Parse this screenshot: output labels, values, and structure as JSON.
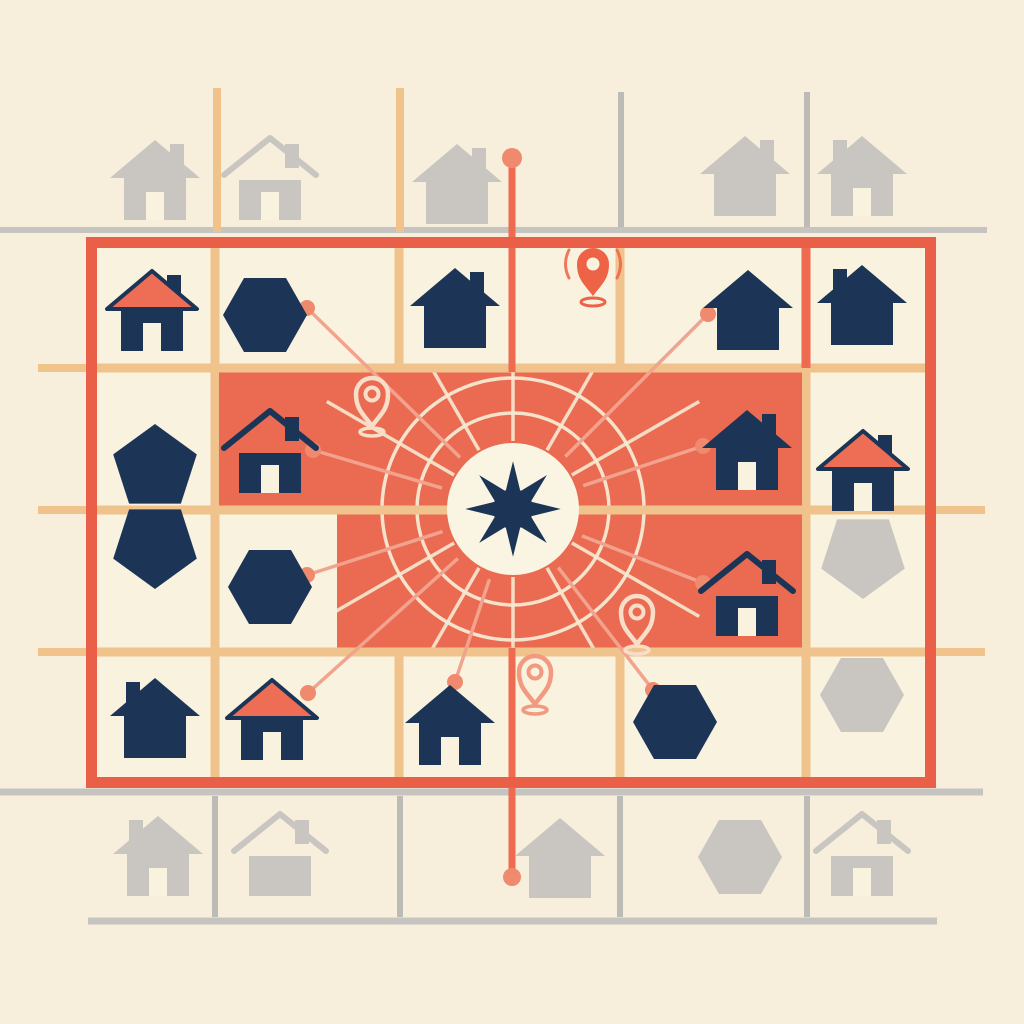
{
  "canvas": {
    "w": 1024,
    "h": 1024
  },
  "palette": {
    "bg": "#F7EFDB",
    "cream": "#F9F2DF",
    "coral_zone": "#EB6A52",
    "coral_border": "#E95F47",
    "coral_roof": "#ED6E55",
    "tan": "#F1C38C",
    "navy": "#1C3557",
    "gray_icon": "#C9C6C1",
    "gray_line": "#BDBBB6",
    "gray_line_light": "#C6C4C0",
    "connector": "#F2A38E",
    "connector_dot": "#EF8A6F",
    "ring": "#F7EAD2",
    "hub_circle": "#FAF4E2",
    "axis": "#EE6A50",
    "pin_filled": "#EE6245",
    "pin_outline_on_coral": "#F8DEC8",
    "pin_outline_on_cream": "#F2997F"
  },
  "outer_lines": {
    "gray_h": [
      {
        "x1": 0,
        "y": 230,
        "x2": 987,
        "w": 6
      },
      {
        "x1": 0,
        "y": 792,
        "x2": 983,
        "w": 7
      },
      {
        "x1": 88,
        "y": 921,
        "x2": 937,
        "w": 7
      }
    ],
    "gray_v": [
      {
        "x": 621,
        "y1": 92,
        "y2": 227
      },
      {
        "x": 807,
        "y1": 92,
        "y2": 227
      },
      {
        "x": 215,
        "y1": 796,
        "y2": 917
      },
      {
        "x": 400,
        "y1": 796,
        "y2": 917
      },
      {
        "x": 620,
        "y1": 796,
        "y2": 917
      },
      {
        "x": 807,
        "y1": 796,
        "y2": 917
      }
    ],
    "tan_v": [
      {
        "x": 217,
        "y1": 88,
        "y2": 232
      },
      {
        "x": 400,
        "y1": 88,
        "y2": 232
      }
    ],
    "tan_stubs": [
      {
        "x1": 38,
        "y": 368,
        "x2": 88
      },
      {
        "x1": 38,
        "y": 510,
        "x2": 88
      },
      {
        "x1": 38,
        "y": 652,
        "x2": 88
      },
      {
        "x1": 934,
        "y": 510,
        "x2": 985
      },
      {
        "x1": 934,
        "y": 652,
        "x2": 985
      }
    ]
  },
  "map": {
    "x": 86,
    "y": 237,
    "w": 850,
    "h": 551,
    "border_w": 11,
    "inner_v": [
      215,
      399,
      620,
      806
    ],
    "inner_h": [
      368,
      510,
      652
    ],
    "coral_v_segment": {
      "x": 806,
      "y1": 246,
      "y2": 368
    }
  },
  "zones": [
    {
      "x": 219,
      "y": 368,
      "w": 583,
      "h": 142
    },
    {
      "x": 337,
      "y": 510,
      "w": 465,
      "h": 142
    }
  ],
  "hub": {
    "cx": 513,
    "cy": 509,
    "r": 66,
    "star_outer": 52,
    "star_inner": 21,
    "rings": [
      96,
      131
    ],
    "spoke_count": 12,
    "spoke_inner": 68,
    "spoke_outer": 215
  },
  "axis_line": {
    "x": 512,
    "w": 7,
    "segments": [
      {
        "y1": 158,
        "y2": 372
      },
      {
        "y1": 648,
        "y2": 877
      }
    ],
    "dots": [
      {
        "y": 158,
        "r": 10
      },
      {
        "y": 877,
        "r": 9
      }
    ]
  },
  "connectors": [
    {
      "x": 307,
      "y": 308,
      "curve": 1
    },
    {
      "x": 313,
      "y": 450,
      "curve": 0
    },
    {
      "x": 307,
      "y": 575,
      "curve": 0
    },
    {
      "x": 308,
      "y": 693,
      "curve": 0
    },
    {
      "x": 455,
      "y": 682,
      "curve": 0
    },
    {
      "x": 653,
      "y": 690,
      "curve": 0
    },
    {
      "x": 703,
      "y": 583,
      "curve": 0
    },
    {
      "x": 703,
      "y": 446,
      "curve": 0
    },
    {
      "x": 708,
      "y": 314,
      "curve": 1
    }
  ],
  "icons": [
    {
      "t": "house",
      "v": "coral",
      "x": 152,
      "y": 308,
      "c": "navy",
      "ch": "r",
      "door": true
    },
    {
      "t": "house",
      "v": "solid",
      "x": 455,
      "y": 305,
      "c": "navy",
      "ch": "r",
      "door": false
    },
    {
      "t": "house",
      "v": "solid",
      "x": 748,
      "y": 307,
      "c": "navy",
      "ch": "none",
      "door": false
    },
    {
      "t": "house",
      "v": "solid",
      "x": 862,
      "y": 302,
      "c": "navy",
      "ch": "l",
      "door": false
    },
    {
      "t": "house",
      "v": "gap",
      "x": 270,
      "y": 450,
      "c": "navy",
      "ch": "r",
      "door": true
    },
    {
      "t": "house",
      "v": "solid",
      "x": 747,
      "y": 447,
      "c": "navy",
      "ch": "r",
      "door": true
    },
    {
      "t": "house",
      "v": "coral",
      "x": 863,
      "y": 468,
      "c": "navy",
      "ch": "r",
      "door": true
    },
    {
      "t": "house",
      "v": "gap",
      "x": 747,
      "y": 593,
      "c": "navy",
      "ch": "r",
      "door": true
    },
    {
      "t": "house",
      "v": "solid",
      "x": 155,
      "y": 715,
      "c": "navy",
      "ch": "l",
      "door": false
    },
    {
      "t": "house",
      "v": "coral",
      "x": 272,
      "y": 717,
      "c": "navy",
      "ch": "none",
      "door": true
    },
    {
      "t": "house",
      "v": "solid",
      "x": 450,
      "y": 722,
      "c": "navy",
      "ch": "none",
      "door": true
    },
    {
      "t": "house",
      "v": "solid",
      "x": 155,
      "y": 177,
      "c": "gray",
      "ch": "r",
      "door": true
    },
    {
      "t": "house",
      "v": "gap",
      "x": 270,
      "y": 177,
      "c": "gray",
      "ch": "r",
      "door": true
    },
    {
      "t": "house",
      "v": "solid",
      "x": 457,
      "y": 181,
      "c": "gray",
      "ch": "r",
      "door": false
    },
    {
      "t": "house",
      "v": "solid",
      "x": 745,
      "y": 173,
      "c": "gray",
      "ch": "r",
      "door": false
    },
    {
      "t": "house",
      "v": "solid",
      "x": 862,
      "y": 173,
      "c": "gray",
      "ch": "l",
      "door": true
    },
    {
      "t": "house",
      "v": "solid",
      "x": 158,
      "y": 853,
      "c": "gray",
      "ch": "l",
      "door": true
    },
    {
      "t": "house",
      "v": "gap",
      "x": 280,
      "y": 853,
      "c": "gray",
      "ch": "r",
      "door": false
    },
    {
      "t": "house",
      "v": "solid",
      "x": 560,
      "y": 855,
      "c": "gray",
      "ch": "none",
      "door": false
    },
    {
      "t": "house",
      "v": "gap",
      "x": 862,
      "y": 853,
      "c": "gray",
      "ch": "r",
      "door": true
    },
    {
      "t": "hex",
      "x": 265,
      "y": 315,
      "c": "navy"
    },
    {
      "t": "hex",
      "x": 270,
      "y": 587,
      "c": "navy"
    },
    {
      "t": "hex",
      "x": 675,
      "y": 722,
      "c": "navy"
    },
    {
      "t": "hex",
      "x": 862,
      "y": 695,
      "c": "gray"
    },
    {
      "t": "hex",
      "x": 740,
      "y": 857,
      "c": "gray"
    },
    {
      "t": "pent",
      "dir": "up",
      "x": 155,
      "y": 468,
      "c": "navy"
    },
    {
      "t": "pent",
      "dir": "down",
      "x": 155,
      "y": 545,
      "c": "navy"
    },
    {
      "t": "pent",
      "dir": "down",
      "x": 863,
      "y": 555,
      "c": "gray"
    },
    {
      "t": "pin",
      "v": "signal",
      "x": 593,
      "y": 296
    },
    {
      "t": "pin",
      "v": "outline_coral",
      "x": 372,
      "y": 426
    },
    {
      "t": "pin",
      "v": "outline_coral",
      "x": 637,
      "y": 644
    },
    {
      "t": "pin",
      "v": "outline_cream",
      "x": 535,
      "y": 704
    }
  ]
}
